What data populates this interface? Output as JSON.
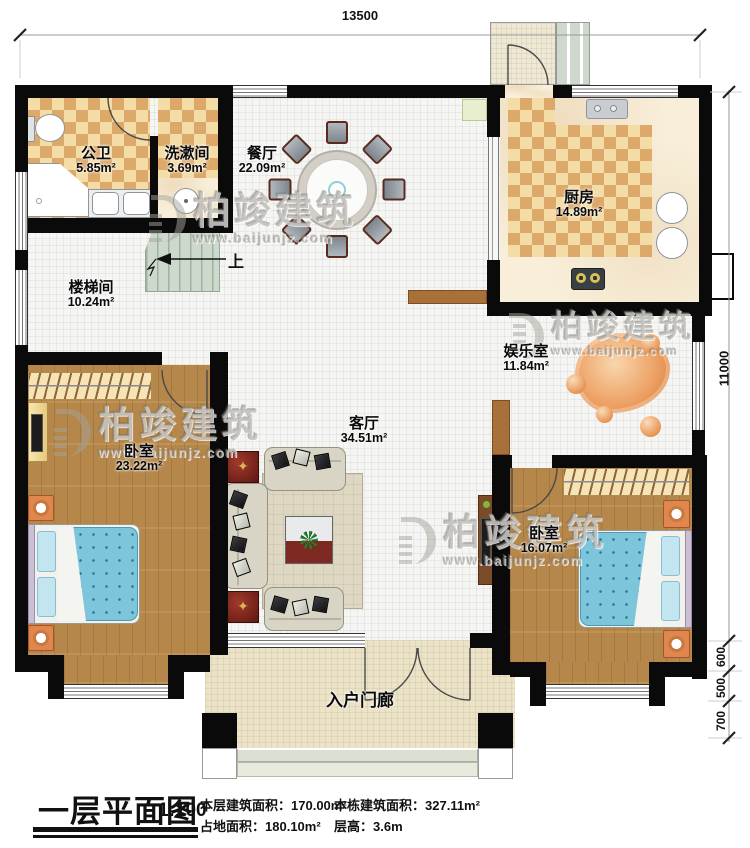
{
  "dim": {
    "top": "13500",
    "right": "11000",
    "seg600": "600",
    "seg500": "500",
    "seg700": "700"
  },
  "rooms": {
    "gongwei": {
      "name": "公卫",
      "area": "5.85m²"
    },
    "xishujian": {
      "name": "洗漱间",
      "area": "3.69m²"
    },
    "canting": {
      "name": "餐厅",
      "area": "22.09m²"
    },
    "chufang": {
      "name": "厨房",
      "area": "14.89m²"
    },
    "loutijian": {
      "name": "楼梯间",
      "area": "10.24m²"
    },
    "yuleshi": {
      "name": "娱乐室",
      "area": "11.84m²"
    },
    "keting": {
      "name": "客厅",
      "area": "34.51m²"
    },
    "woshi1": {
      "name": "卧室",
      "area": "23.22m²"
    },
    "woshi2": {
      "name": "卧室",
      "area": "16.07m²"
    },
    "menlang": {
      "name": "入户门廊"
    }
  },
  "stairs": {
    "up": "上"
  },
  "titleblock": {
    "title": "一层平面图",
    "scale": "1:100"
  },
  "stats": {
    "floor_area_label": "本层建筑面积：",
    "floor_area": "170.00m²",
    "total_area_label": "本栋建筑面积：",
    "total_area": "327.11m²",
    "land_area_label": "占地面积：",
    "land_area": "180.10m²",
    "storey_label": "层高：",
    "storey": "3.6m"
  },
  "watermark": {
    "brand": "柏竣建筑",
    "url": "www.baijunjz.com"
  },
  "colors": {
    "wall": "#0a0a0a",
    "checker_dark": "#dca96b",
    "wood": "#b5874a",
    "quilt": "#7cc5da",
    "accent_orange": "#e8995f"
  }
}
